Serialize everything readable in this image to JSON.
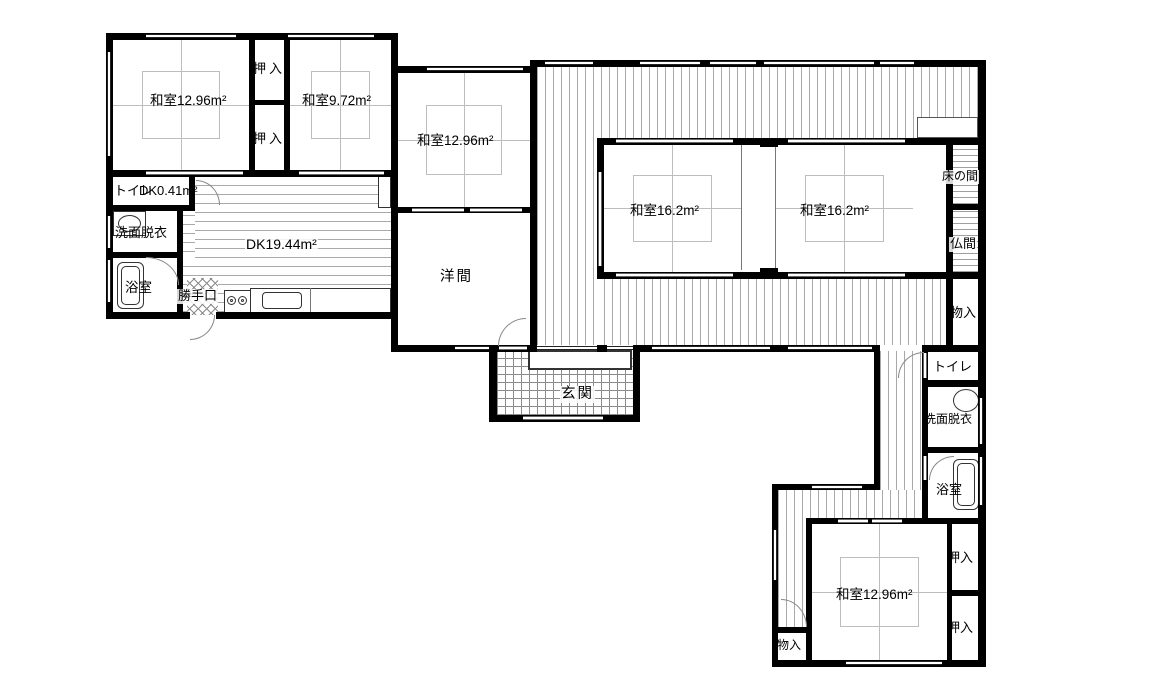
{
  "plan": {
    "labels": {
      "washitsu_tl": "和室12.96m²",
      "oshiire_tl_upper": "押入",
      "oshiire_tl_lower": "押入",
      "washitsu_tr": "和室9.72m²",
      "toilet_left": "トイレ",
      "dk_small": "DK0.41m²",
      "senmen_left": "洗面脱衣",
      "bath_left": "浴室",
      "dk_main": "DK19.44m²",
      "katteguchi": "勝手口",
      "washitsu_mid": "和室12.96m²",
      "youma": "洋間",
      "genkan": "玄関",
      "washitsu_c1": "和室16.2m²",
      "washitsu_c2": "和室16.2m²",
      "tokonoma": "床の間",
      "butsuma": "仏間",
      "monoire_right": "物入",
      "toilet_right": "トイレ",
      "senmen_right": "洗面脱衣",
      "bath_right": "浴室",
      "oshiire_br_upper": "押入",
      "washitsu_br": "和室12.96m²",
      "oshiire_br_lower": "押入",
      "monoire_bottom": "物入"
    },
    "icons": [
      "bathtub-icon",
      "washbasin-icon",
      "kitchen-sink-icon",
      "stove-icon",
      "shoe-cabinet-icon",
      "door-swing-arc"
    ],
    "colors": {
      "wall": "#000000",
      "floor_lines": "#a9a9a9",
      "background": "#ffffff"
    }
  }
}
